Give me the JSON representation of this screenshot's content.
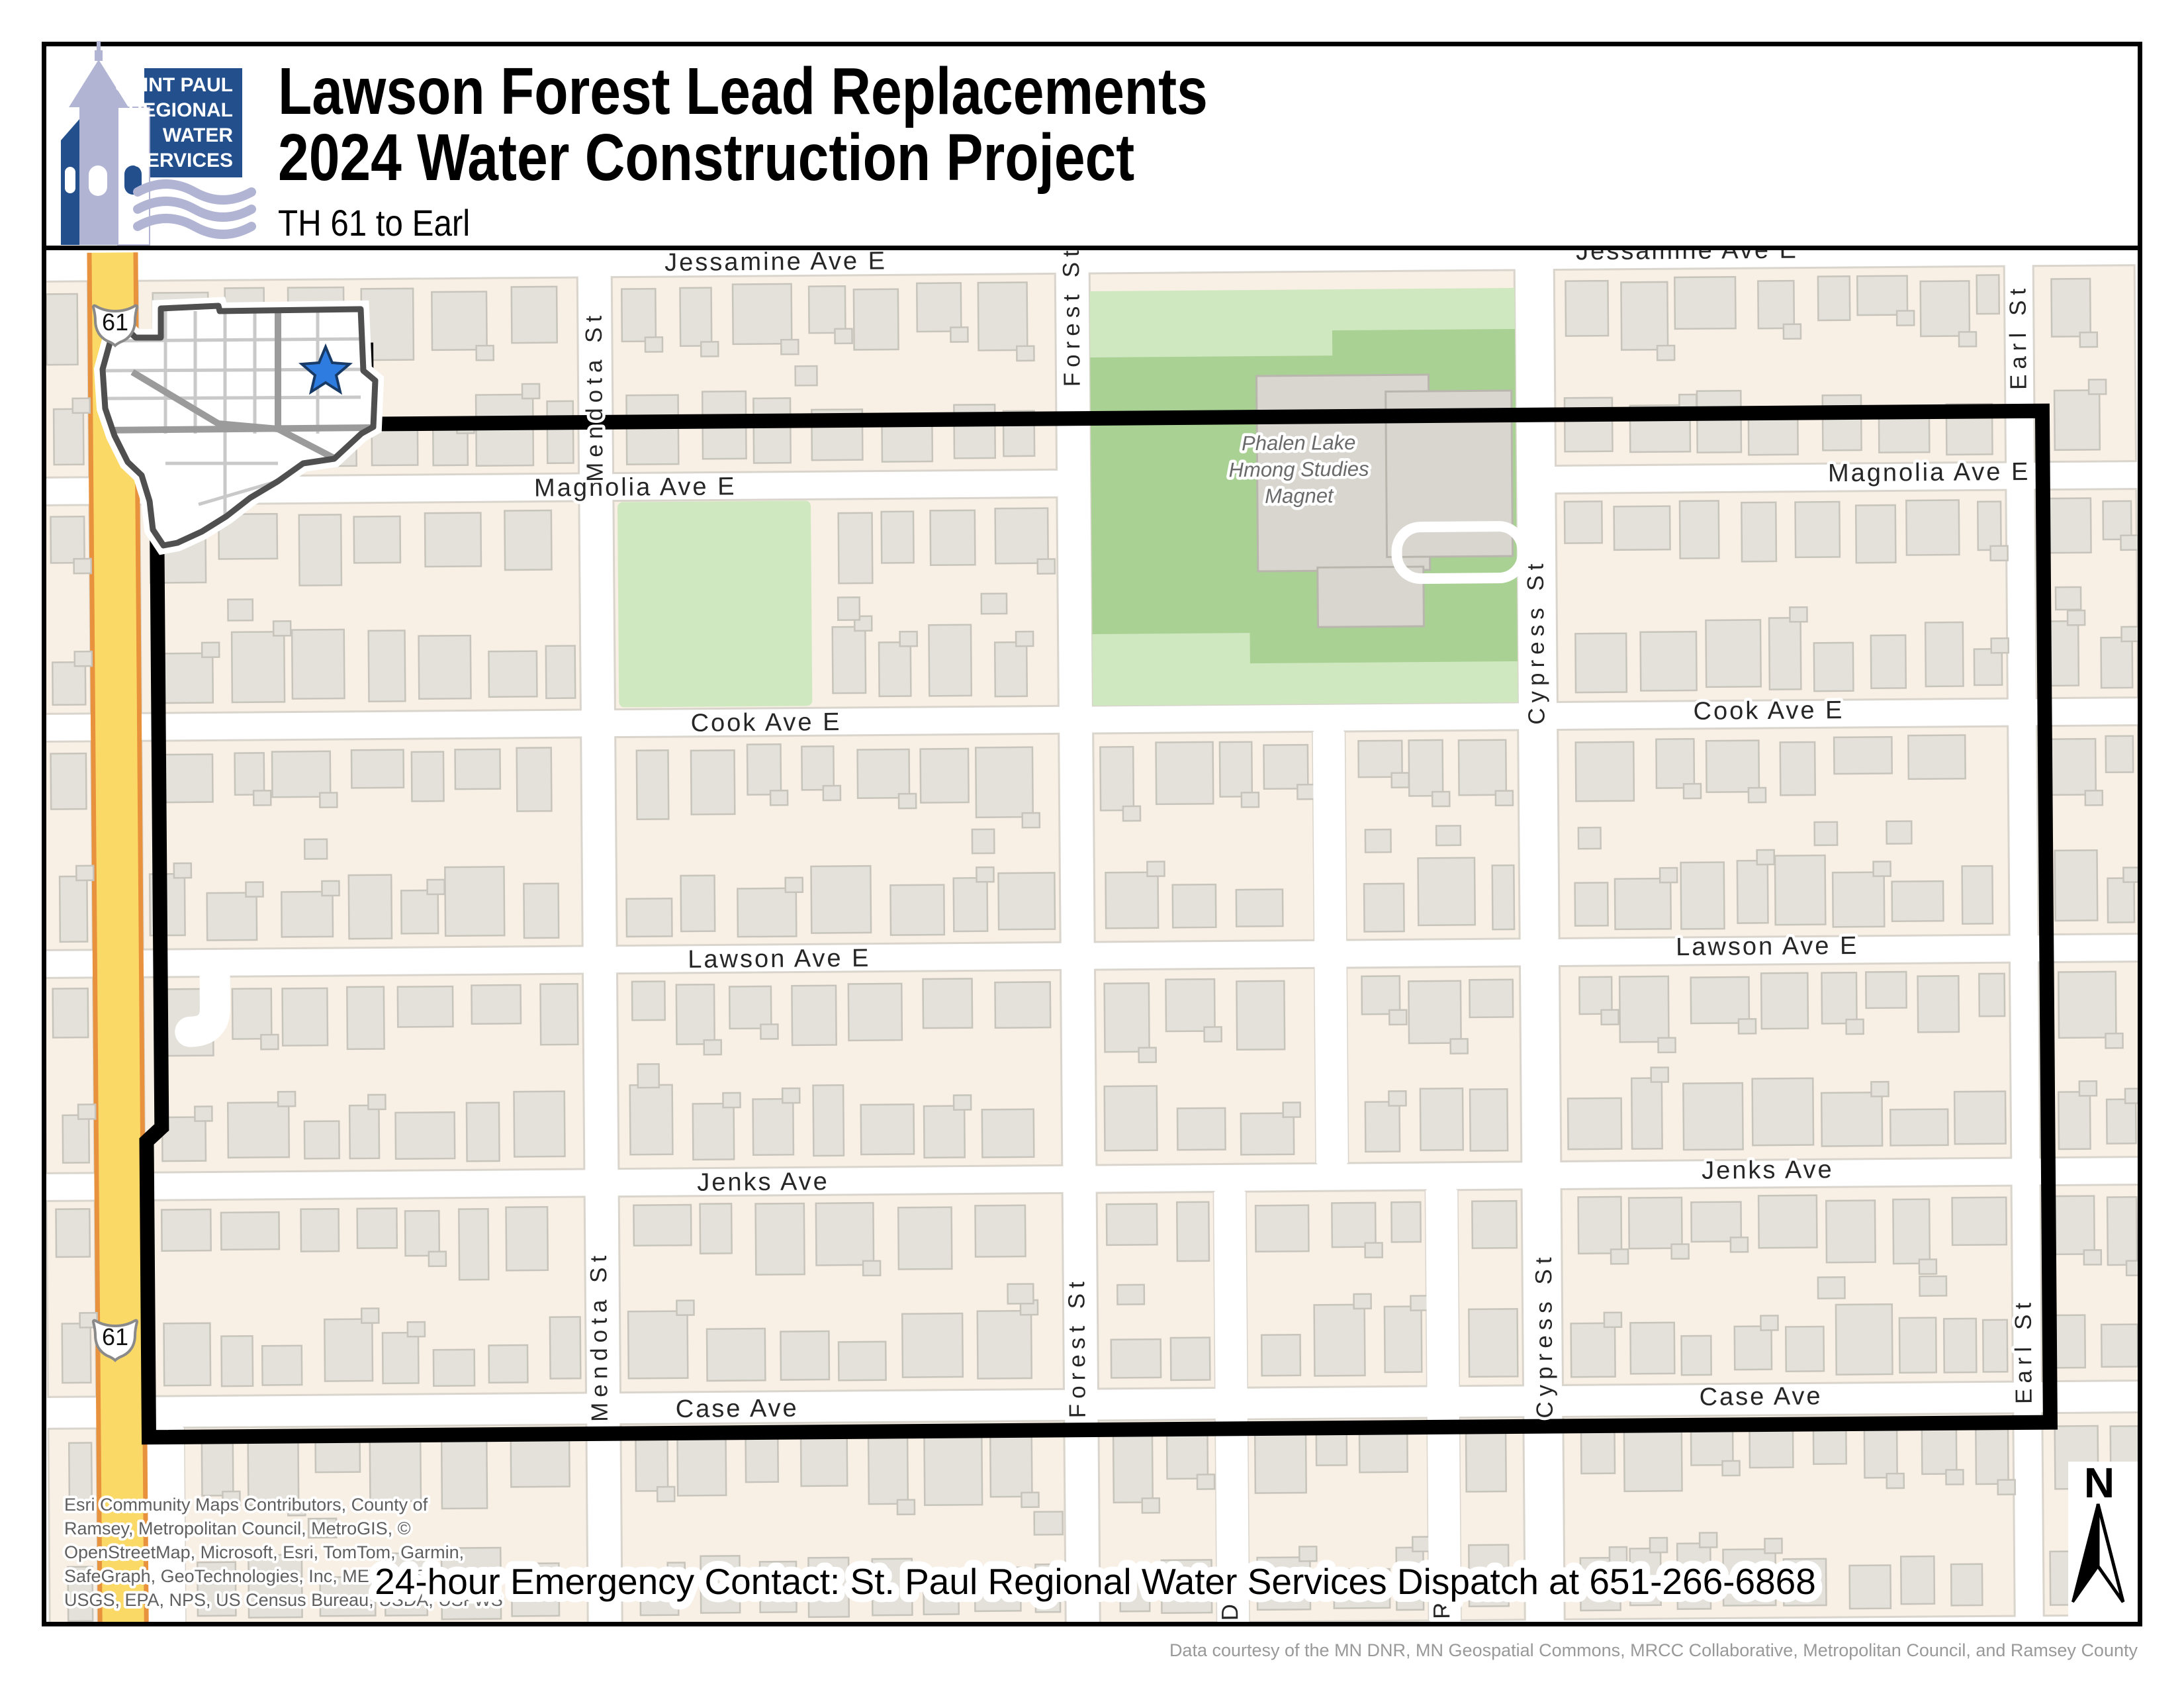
{
  "header": {
    "title_line1": "Lawson Forest Lead Replacements",
    "title_line2": "2024 Water Construction Project",
    "subtitle": "TH 61 to Earl",
    "logo": {
      "line1": "SAINT PAUL",
      "line2": "REGIONAL",
      "line3": "WATER",
      "line4": "SERVICES"
    }
  },
  "map": {
    "streets": {
      "jessamine": "Jessamine Ave E",
      "magnolia": "Magnolia Ave E",
      "cook": "Cook Ave E",
      "lawson": "Lawson Ave E",
      "jenks": "Jenks Ave",
      "case": "Case Ave",
      "mendota": "Mendota St",
      "forest": "Forest St",
      "cypress": "Cypress St",
      "earl": "Earl St",
      "duchess_partial": "Duc",
      "rush_partial": "Rus"
    },
    "school_label": {
      "line1": "Phalen Lake",
      "line2": "Hmong Studies",
      "line3": "Magnet"
    },
    "highway_shield": "61",
    "north_label": "N",
    "colors": {
      "project_boundary": "#000000",
      "highway_yellow": "#fbd966",
      "highway_orange": "#e8923d",
      "block_cream": "#f8efe5",
      "building_gray": "#e4e1da",
      "park_green_light": "#cfe8c0",
      "park_green_dark": "#a8d193",
      "logo_navy": "#234f8d",
      "logo_lavender": "#b2b4d4",
      "inset_star_blue": "#2f7ce0"
    }
  },
  "attribution": {
    "line1": "Esri Community Maps Contributors, County of",
    "line2": "Ramsey, Metropolitan Council, MetroGIS, ©",
    "line3": "OpenStreetMap, Microsoft, Esri, TomTom, Garmin,",
    "line4": "SafeGraph, GeoTechnologies, Inc, METI/NASA,",
    "line5": "USGS, EPA, NPS, US Census Bureau, USDA, USFWS"
  },
  "emergency_contact": "24-hour Emergency Contact: St. Paul Regional Water Services Dispatch at 651-266-6868",
  "data_courtesy": "Data courtesy of the MN DNR, MN Geospatial Commons, MRCC Collaborative, Metropolitan Council, and Ramsey County"
}
